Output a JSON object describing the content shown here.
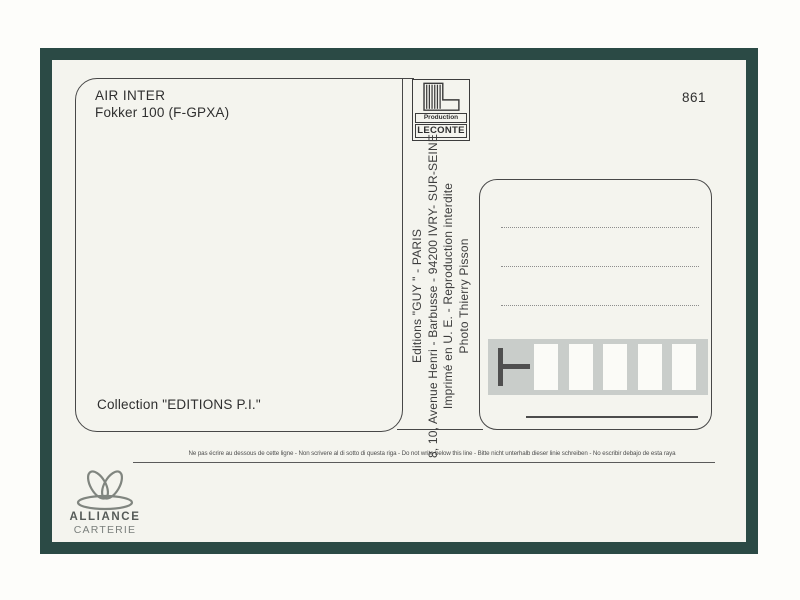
{
  "card": {
    "number": "861",
    "photo_caption": {
      "airline": "AIR INTER",
      "aircraft": "Fokker 100 (F-GPXA)",
      "collection": "Collection \"EDITIONS P.I.\""
    },
    "producer_logo": {
      "line1": "Production",
      "line2": "LECONTE"
    },
    "imprint": {
      "editions": "Editions \"GUY \" - PARIS",
      "address": "8, 10, Avenue Henri - Barbusse - 94200 IVRY- SUR-SEINE",
      "printed": "Imprimé en U. E. - Reproduction interdite",
      "photo_credit": "Photo Thierry Pisson"
    },
    "warning": "Ne pas écrire au dessous de cette ligne - Non scrivere al di sotto di questa riga - Do not write below this line - Bitte nicht unterhalb dieser linie schreiben - No escribir debajo de esta raya",
    "brand": {
      "name": "ALLIANCE",
      "type": "CARTERIE"
    },
    "colors": {
      "frame_green": "#2b4a45",
      "card_background": "#f4f4ee",
      "postal_bar_gray": "#c9cdca",
      "ink": "#3d3d3d"
    }
  }
}
